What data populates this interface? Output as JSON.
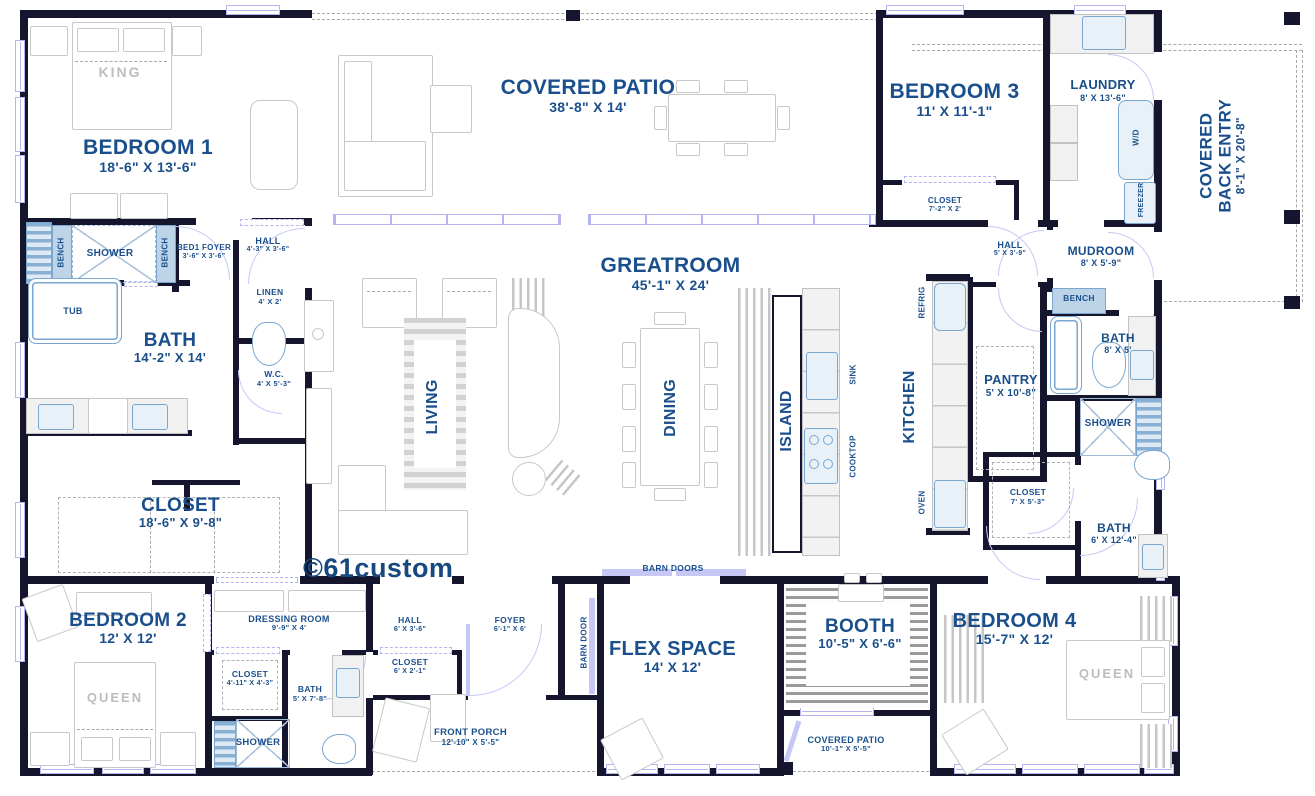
{
  "watermark": "©61custom",
  "colors": {
    "wall": "#15152e",
    "label_blue": "#1b4f8c",
    "fixture_blue": "#7aa6cf",
    "door_lavender": "#b4b4f2",
    "furniture_gray": "#c8c8c8"
  },
  "rooms": {
    "bedroom1": {
      "name": "BEDROOM 1",
      "dims": "18'-6\" X 13'-6\""
    },
    "covered_patio": {
      "name": "COVERED PATIO",
      "dims": "38'-8\" X 14'"
    },
    "bedroom3": {
      "name": "BEDROOM 3",
      "dims": "11' X 11'-1\""
    },
    "laundry": {
      "name": "LAUNDRY",
      "dims": "8' X 13'-6\""
    },
    "covered_back_entry": {
      "line1": "COVERED",
      "line2": "BACK ENTRY",
      "dims": "8'-1\" X 20'-8\""
    },
    "bed1_foyer": {
      "name": "BED1 FOYER",
      "dims": "3'-6\" X 3'-6\""
    },
    "hall_bed1": {
      "name": "HALL",
      "dims": "4'-3\" X 3'-6\""
    },
    "bath_master": {
      "name": "BATH",
      "dims": "14'-2\" X 14'"
    },
    "linen": {
      "name": "LINEN",
      "dims": "4' X 2'"
    },
    "wc": {
      "name": "W.C.",
      "dims": "4' X 5'-3\""
    },
    "closet_master": {
      "name": "CLOSET",
      "dims": "18'-6\" X 9'-8\""
    },
    "greatroom": {
      "name": "GREATROOM",
      "dims": "45'-1\" X 24'"
    },
    "closet_bed3": {
      "name": "CLOSET",
      "dims": "7'-2\" X 2'"
    },
    "hall_kitchen": {
      "name": "HALL",
      "dims": "5' X 3'-9\""
    },
    "mudroom": {
      "name": "MUDROOM",
      "dims": "8' X 5'-9\""
    },
    "bath_mudroom": {
      "name": "BATH",
      "dims": "8' X 5'"
    },
    "pantry": {
      "name": "PANTRY",
      "dims": "5' X 10'-8\""
    },
    "closet_hall": {
      "name": "CLOSET",
      "dims": "7' X 5'-3\""
    },
    "bath_hall": {
      "name": "BATH",
      "dims": "6' X 12'-4\""
    },
    "bedroom2": {
      "name": "BEDROOM 2",
      "dims": "12' X 12'"
    },
    "dressing_room": {
      "name": "DRESSING ROOM",
      "dims": "9'-9\" X 4'"
    },
    "closet_bed2": {
      "name": "CLOSET",
      "dims": "4'-11\" X 4'-3\""
    },
    "bath_bed2": {
      "name": "BATH",
      "dims": "5' X 7'-8\""
    },
    "hall_foyer": {
      "name": "HALL",
      "dims": "6' X 3'-6\""
    },
    "closet_foyer": {
      "name": "CLOSET",
      "dims": "6' X 2'-1\""
    },
    "foyer": {
      "name": "FOYER",
      "dims": "6'-1\" X 6'"
    },
    "front_porch": {
      "name": "FRONT PORCH",
      "dims": "12'-10\" X 5'-5\""
    },
    "flex_space": {
      "name": "FLEX SPACE",
      "dims": "14' X 12'"
    },
    "booth": {
      "name": "BOOTH",
      "dims": "10'-5\" X 6'-6\""
    },
    "covered_patio_rear": {
      "name": "COVERED PATIO",
      "dims": "10'-1\" X 5'-5\""
    },
    "bedroom4": {
      "name": "BEDROOM 4",
      "dims": "15'-7\" X 12'"
    }
  },
  "areas": {
    "living": "LIVING",
    "dining": "DINING",
    "island": "ISLAND",
    "kitchen": "KITCHEN"
  },
  "fixtures": {
    "king": "KING",
    "queen_bed2": "QUEEN",
    "queen_bed4": "QUEEN",
    "tub": "TUB",
    "shower_master": "SHOWER",
    "bench_left": "BENCH",
    "bench_right": "BENCH",
    "shower_hall": "SHOWER",
    "shower_bed2": "SHOWER",
    "bench_mudroom": "BENCH",
    "sink": "SINK",
    "cooktop": "COOKTOP",
    "refrig": "REFRIG",
    "oven": "OVEN",
    "wd": "W/D",
    "freezer": "FREEZER",
    "barn_doors": "BARN DOORS",
    "barn_door": "BARN DOOR"
  }
}
